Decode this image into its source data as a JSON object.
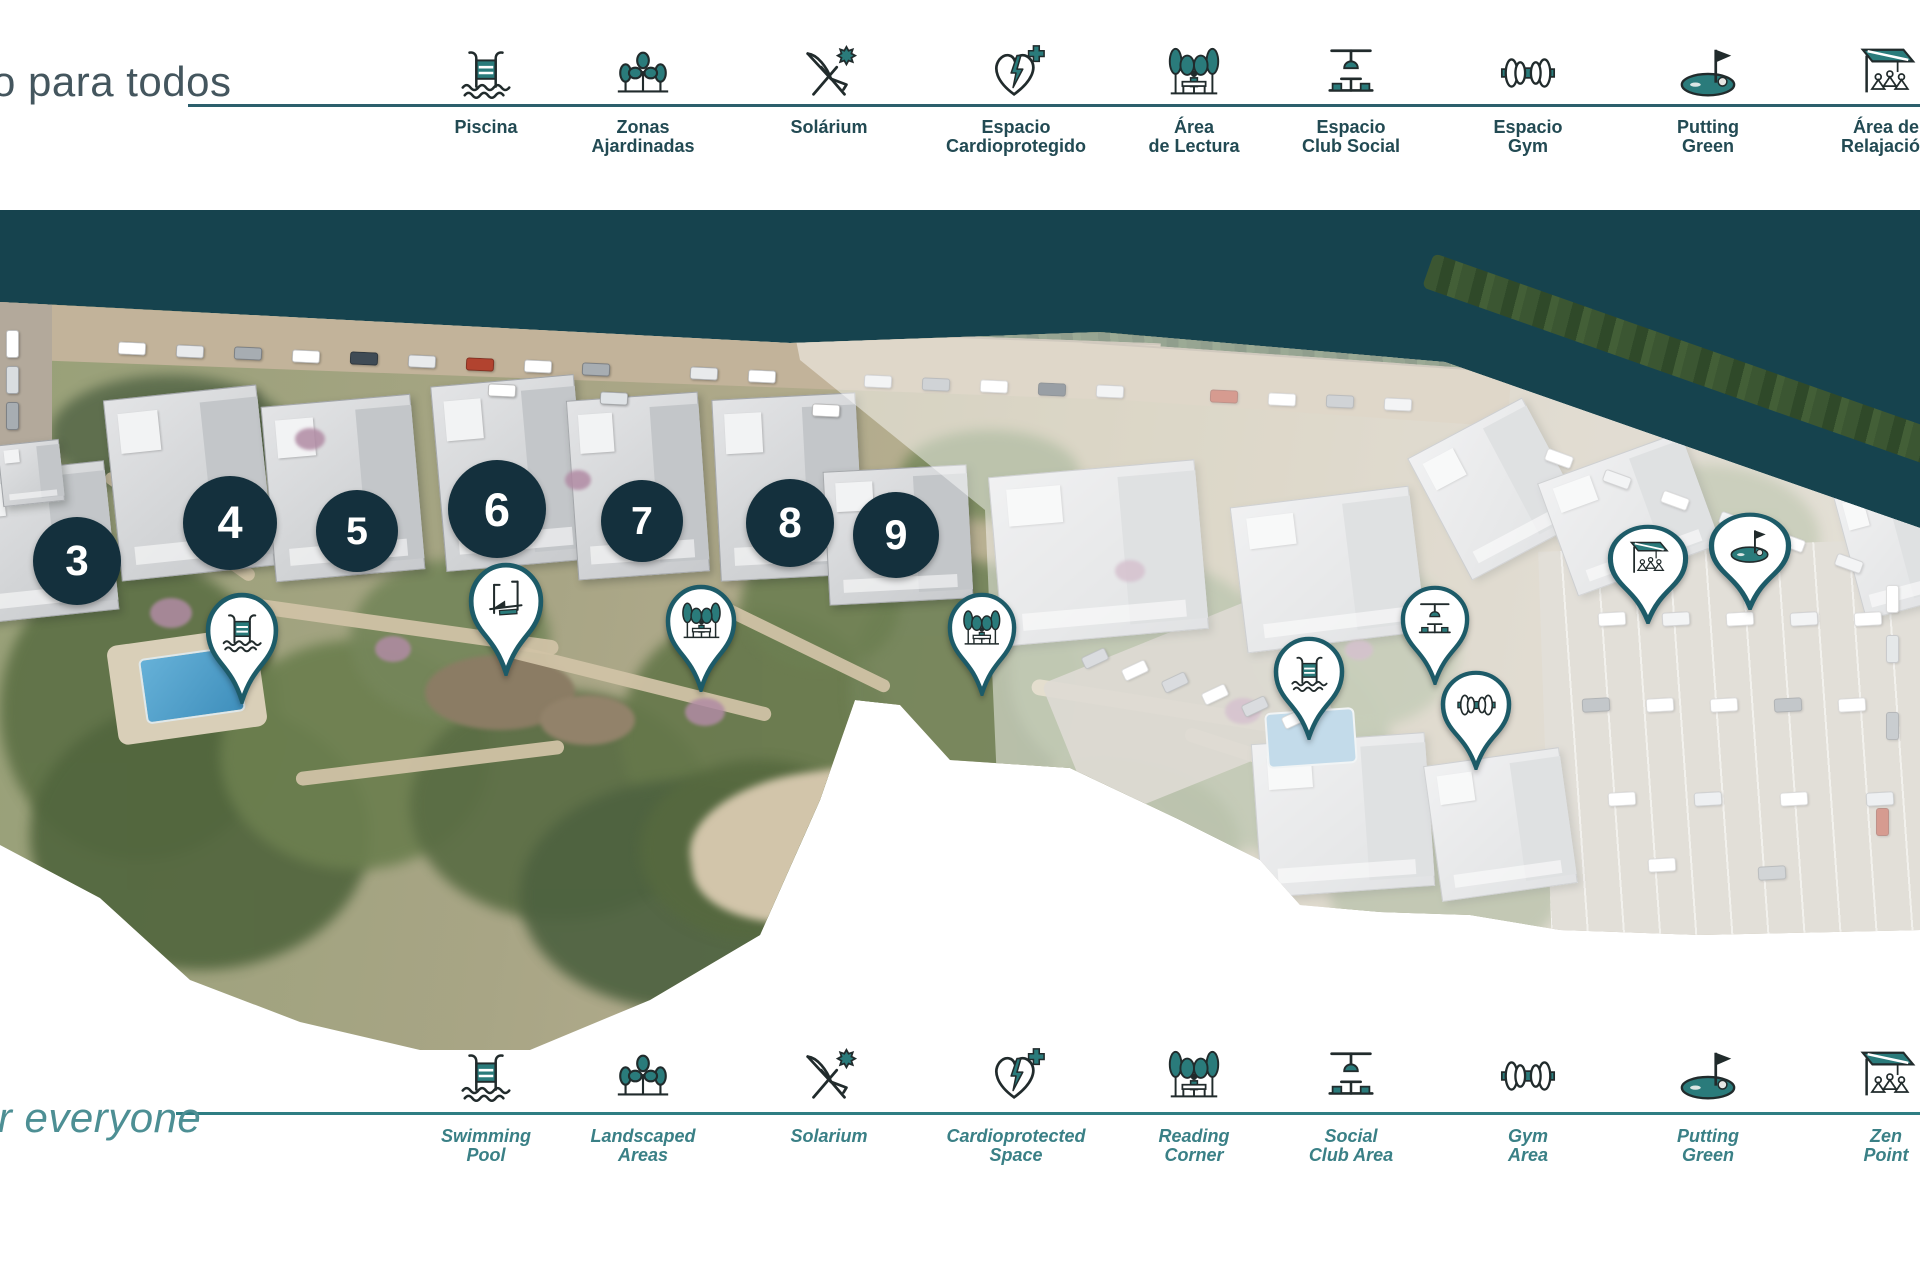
{
  "palette": {
    "teal_band": "#16434e",
    "icon_teal": "#2a7b7b",
    "icon_ink": "#212b2c",
    "circle_bg": "#14303d",
    "pin_border": "#1d5b68",
    "label_es": "#224a53",
    "label_en": "#3a8086",
    "title_es": "#44565e",
    "title_en": "#4d8f94",
    "line_es": "#2c5f6c",
    "line_en": "#2f7e83"
  },
  "top": {
    "title": "o para todos",
    "items": [
      {
        "id": "piscina",
        "icon": "pool",
        "x": 486,
        "lines": [
          "Piscina"
        ]
      },
      {
        "id": "zonas-ajardinadas",
        "icon": "trees",
        "x": 643,
        "lines": [
          "Zonas",
          "Ajardinadas"
        ]
      },
      {
        "id": "solarium",
        "icon": "solarium",
        "x": 829,
        "lines": [
          "Solárium"
        ]
      },
      {
        "id": "espacio-cardioprotegido",
        "icon": "cardio",
        "x": 1016,
        "lines": [
          "Espacio",
          "Cardioprotegido"
        ]
      },
      {
        "id": "area-de-lectura",
        "icon": "reading",
        "x": 1194,
        "lines": [
          "Área",
          "de Lectura"
        ]
      },
      {
        "id": "espacio-club-social",
        "icon": "social",
        "x": 1351,
        "lines": [
          "Espacio",
          "Club Social"
        ]
      },
      {
        "id": "espacio-gym",
        "icon": "gym",
        "x": 1528,
        "lines": [
          "Espacio",
          "Gym"
        ]
      },
      {
        "id": "putting-green",
        "icon": "putting",
        "x": 1708,
        "lines": [
          "Putting",
          "Green"
        ]
      },
      {
        "id": "area-de-relajacion",
        "icon": "zen",
        "x": 1886,
        "lines": [
          "Área de",
          "Relajación"
        ]
      }
    ]
  },
  "bottom": {
    "title": "or everyone",
    "items": [
      {
        "id": "swimming-pool",
        "icon": "pool",
        "x": 486,
        "lines": [
          "Swimming",
          "Pool"
        ]
      },
      {
        "id": "landscaped-areas",
        "icon": "trees",
        "x": 643,
        "lines": [
          "Landscaped",
          "Areas"
        ]
      },
      {
        "id": "solarium",
        "icon": "solarium",
        "x": 829,
        "lines": [
          "Solarium"
        ]
      },
      {
        "id": "cardioprotected-space",
        "icon": "cardio",
        "x": 1016,
        "lines": [
          "Cardioprotected",
          "Space"
        ]
      },
      {
        "id": "reading-corner",
        "icon": "reading",
        "x": 1194,
        "lines": [
          "Reading",
          "Corner"
        ]
      },
      {
        "id": "social-club-area",
        "icon": "social",
        "x": 1351,
        "lines": [
          "Social",
          "Club Area"
        ]
      },
      {
        "id": "gym-area",
        "icon": "gym",
        "x": 1528,
        "lines": [
          "Gym",
          "Area"
        ]
      },
      {
        "id": "putting-green",
        "icon": "putting",
        "x": 1708,
        "lines": [
          "Putting",
          "Green"
        ]
      },
      {
        "id": "zen-point",
        "icon": "zen",
        "x": 1886,
        "lines": [
          "Zen",
          "Point"
        ]
      }
    ]
  },
  "map": {
    "building_numbers": [
      {
        "id": "3",
        "n": "3",
        "x": 77,
        "y": 561,
        "d": 88
      },
      {
        "id": "4",
        "n": "4",
        "x": 230,
        "y": 523,
        "d": 94
      },
      {
        "id": "5",
        "n": "5",
        "x": 357,
        "y": 531,
        "d": 82
      },
      {
        "id": "6",
        "n": "6",
        "x": 497,
        "y": 509,
        "d": 98
      },
      {
        "id": "7",
        "n": "7",
        "x": 642,
        "y": 521,
        "d": 82
      },
      {
        "id": "8",
        "n": "8",
        "x": 790,
        "y": 523,
        "d": 88
      },
      {
        "id": "9",
        "n": "9",
        "x": 896,
        "y": 535,
        "d": 86
      }
    ],
    "markers": [
      {
        "id": "pool-1",
        "icon": "pool",
        "x": 242,
        "y": 592,
        "w": 74,
        "h": 112
      },
      {
        "id": "solarium",
        "icon": "lounger",
        "x": 506,
        "y": 562,
        "w": 76,
        "h": 114
      },
      {
        "id": "reading-1",
        "icon": "reading",
        "x": 701,
        "y": 584,
        "w": 72,
        "h": 108
      },
      {
        "id": "reading-2",
        "icon": "reading",
        "x": 982,
        "y": 592,
        "w": 70,
        "h": 104
      },
      {
        "id": "pool-2",
        "icon": "pool",
        "x": 1309,
        "y": 636,
        "w": 72,
        "h": 104
      },
      {
        "id": "social-club",
        "icon": "social",
        "x": 1435,
        "y": 585,
        "w": 70,
        "h": 100
      },
      {
        "id": "gym",
        "icon": "gym",
        "x": 1476,
        "y": 670,
        "w": 72,
        "h": 100
      },
      {
        "id": "zen",
        "icon": "zen",
        "x": 1648,
        "y": 524,
        "w": 82,
        "h": 100
      },
      {
        "id": "putting",
        "icon": "putting",
        "x": 1750,
        "y": 512,
        "w": 84,
        "h": 98
      }
    ]
  }
}
